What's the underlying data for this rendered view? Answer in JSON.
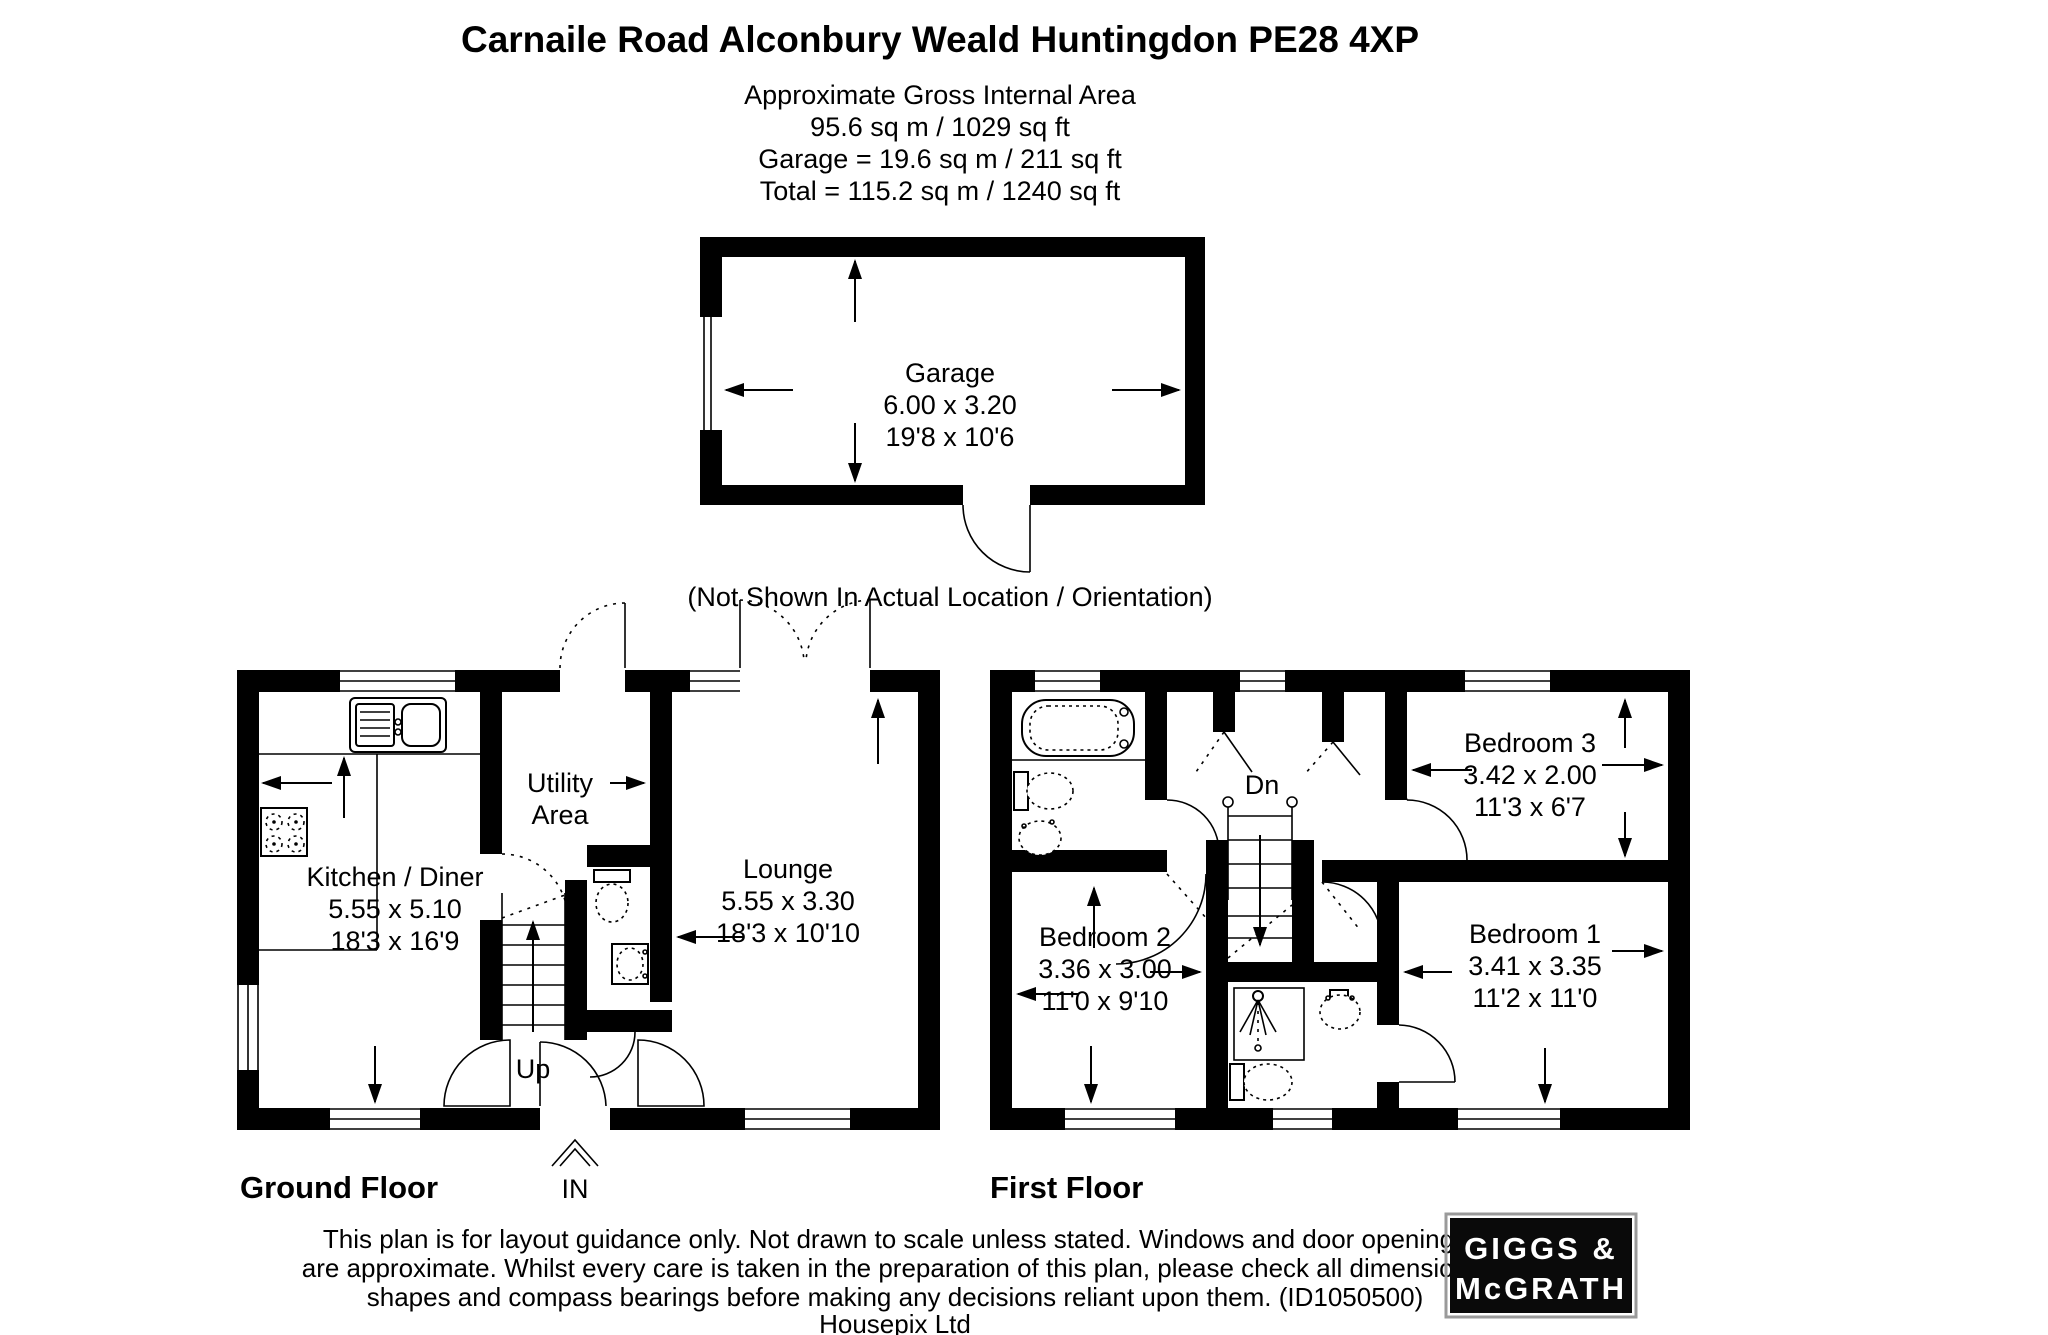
{
  "header": {
    "title": "Carnaile Road Alconbury Weald Huntingdon PE28 4XP",
    "area_lines": [
      "Approximate Gross Internal Area",
      "95.6 sq m / 1029 sq ft",
      "Garage = 19.6 sq m / 211 sq ft",
      "Total = 115.2 sq m / 1240 sq ft"
    ]
  },
  "garage": {
    "name": "Garage",
    "metric": "6.00 x 3.20",
    "imperial": "19'8 x 10'6",
    "note": "(Not Shown In Actual Location / Orientation)"
  },
  "ground_floor": {
    "label": "Ground Floor",
    "kitchen": {
      "name": "Kitchen / Diner",
      "metric": "5.55 x 5.10",
      "imperial": "18'3 x 16'9"
    },
    "utility": {
      "line1": "Utility",
      "line2": "Area"
    },
    "lounge": {
      "name": "Lounge",
      "metric": "5.55 x 3.30",
      "imperial": "18'3 x 10'10"
    },
    "stairs_label": "Up",
    "entrance_label": "IN"
  },
  "first_floor": {
    "label": "First Floor",
    "bedroom1": {
      "name": "Bedroom 1",
      "metric": "3.41 x 3.35",
      "imperial": "11'2 x 11'0"
    },
    "bedroom2": {
      "name": "Bedroom 2",
      "metric": "3.36 x 3.00",
      "imperial": "11'0 x 9'10"
    },
    "bedroom3": {
      "name": "Bedroom 3",
      "metric": "3.42 x 2.00",
      "imperial": "11'3 x 6'7"
    },
    "stairs_label": "Dn"
  },
  "footer": {
    "disclaimer_lines": [
      "This plan is for layout guidance only. Not drawn to scale unless stated. Windows and door openings",
      "are approximate. Whilst every care is taken in the preparation of this plan, please check all dimensions,",
      "shapes and compass bearings before making any decisions reliant upon them. (ID1050500)",
      "Housepix Ltd"
    ],
    "logo": {
      "line1": "GIGGS &",
      "line2": "McGRATH"
    }
  },
  "colors": {
    "wall": "#000000",
    "background": "#ffffff",
    "logo_background": "#0a0a0a",
    "logo_text": "#ffffff",
    "logo_border": "#9a9a9a"
  }
}
